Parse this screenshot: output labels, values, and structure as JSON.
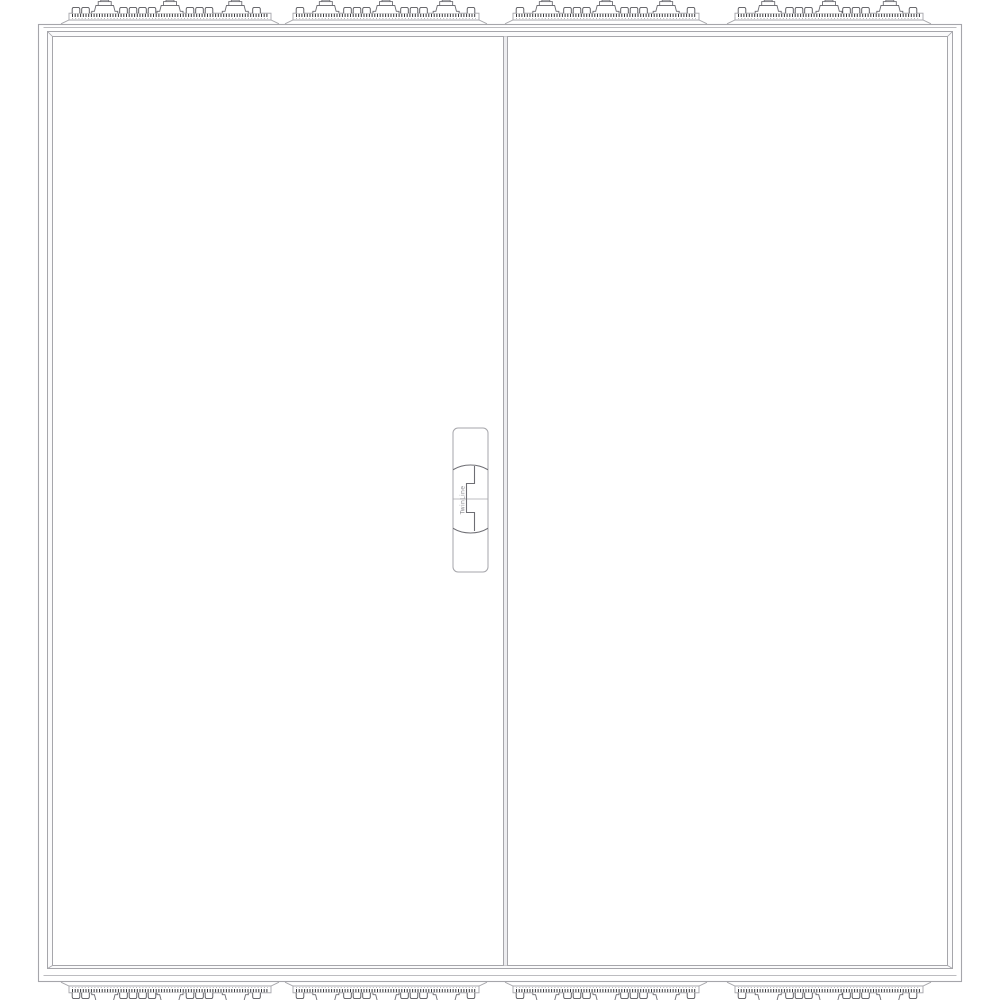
{
  "meta": {
    "description": "Front-view technical line drawing of a floor-standing two-door electrical distribution enclosure with serrated cable-entry flange strips on top and bottom",
    "canvas_width": 1000,
    "canvas_height": 1000
  },
  "colors": {
    "background": "#ffffff",
    "line_light": "#a6a6ab",
    "line_medium": "#6e6e74",
    "line_dark": "#3c3c40",
    "serration": "#37373b",
    "panel_fill": "#ffffff",
    "seam_fill": "#ededf0",
    "label_text": "#8b8b90"
  },
  "enclosure": {
    "body": {
      "x": 38.5,
      "y": 24.5,
      "w": 923,
      "h": 957
    },
    "top_inner_line_y": 27.5,
    "bottom_inner_line_y": 975.5,
    "frame_outer": {
      "x": 47.5,
      "y": 31.5,
      "w": 905,
      "h": 937
    },
    "frame_inner": {
      "x": 52.5,
      "y": 36.5,
      "w": 895,
      "h": 929
    }
  },
  "doors": {
    "count": 2,
    "left": {
      "x": 52.5,
      "y": 36.5,
      "w": 451,
      "h": 929
    },
    "right": {
      "x": 507.5,
      "y": 36.5,
      "w": 440,
      "h": 929
    },
    "seam": {
      "x1": 503.5,
      "x2": 507.5,
      "y1": 36.5,
      "y2": 965.5
    }
  },
  "flange_strips": {
    "top": [
      {
        "x": 68,
        "w": 204
      },
      {
        "x": 292,
        "w": 188
      },
      {
        "x": 512,
        "w": 188
      },
      {
        "x": 734,
        "w": 190
      }
    ],
    "bottom": [
      {
        "x": 68,
        "w": 204
      },
      {
        "x": 292,
        "w": 188
      },
      {
        "x": 512,
        "w": 188
      },
      {
        "x": 734,
        "w": 190
      }
    ],
    "large_grommet_fractions": [
      0.18,
      0.5,
      0.82
    ],
    "large_grommets_per_strip": 3,
    "small_knob_pitch": 9.5
  },
  "handle": {
    "label": "TwinLine",
    "pill": {
      "x": 453,
      "y": 428,
      "w": 35,
      "h": 144,
      "rx": 5
    },
    "circle": {
      "cx": 470.5,
      "cy": 499,
      "r": 34
    },
    "midline_y": 499,
    "key_step_path": "M474.5,466 L474.5,483.5 L466.5,483.5 L466.5,512.5 L474.5,512.5 L474.5,531"
  }
}
